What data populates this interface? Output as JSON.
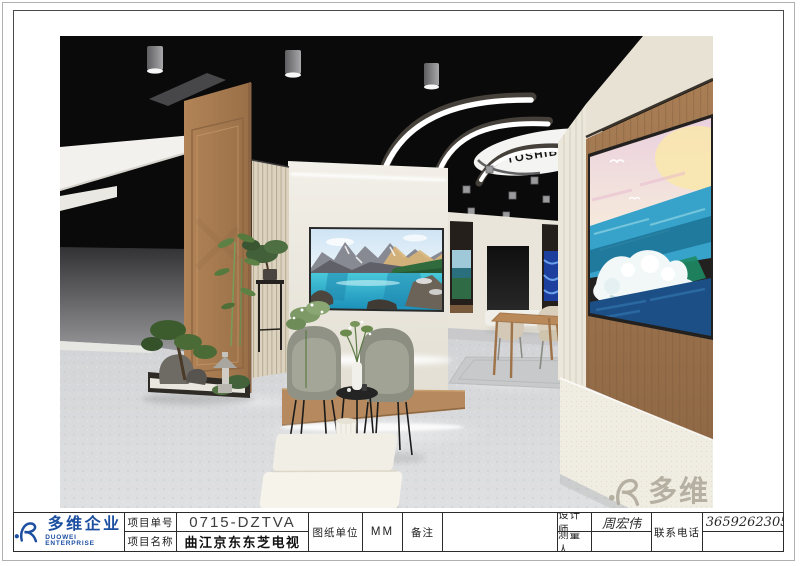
{
  "company": {
    "name_cn": "多维企业",
    "name_en": "DUOWEI ENTERPRISE",
    "brand_blue": "#1d4fa1"
  },
  "render": {
    "toshiba_logo": "TOSHIBA"
  },
  "title_block": {
    "project_no_label": "项目单号",
    "project_no": "0715-DZTVA",
    "project_name_label": "项目名称",
    "project_name": "曲江京东东芝电视",
    "unit_label": "图纸单位",
    "unit": "MM",
    "remark_label": "备注",
    "remark": "",
    "designer_label": "设计师",
    "designer": "周宏伟",
    "surveyor_label": "测量人",
    "surveyor": "",
    "phone_label": "联系电话",
    "phone": "13659262305"
  },
  "watermark": {
    "text": "多维",
    "color": "#a8a294"
  },
  "scene_colors": {
    "ceiling": "#0a0a0a",
    "floor": "#d8d9db",
    "wood": "#a87c54",
    "cream_wall": "#ece8de"
  }
}
